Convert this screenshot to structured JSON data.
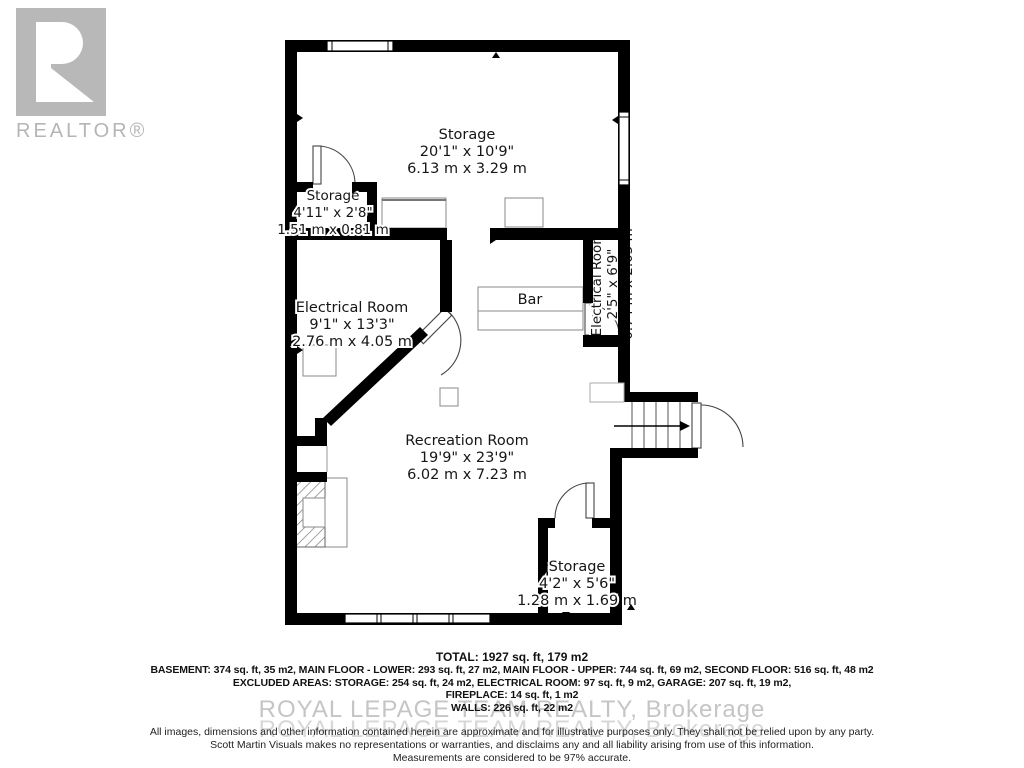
{
  "branding": {
    "logo_label": "REALTOR®",
    "watermark": "ROYAL LEPAGE TEAM REALTY, Brokerage"
  },
  "colors": {
    "wall": "#000000",
    "logo_gray": "#b8b8b8",
    "watermark_gray": "#c5c5c5",
    "label_text": "#161616"
  },
  "rooms": [
    {
      "id": "storage-main",
      "name": "Storage",
      "imperial": "20'1\" x 10'9\"",
      "metric": "6.13 m x 3.29 m"
    },
    {
      "id": "storage-small",
      "name": "Storage",
      "imperial": "4'11\" x 2'8\"",
      "metric": "1.51 m x 0.81 m"
    },
    {
      "id": "electrical-room",
      "name": "Electrical Room",
      "imperial": "9'1\" x 13'3\"",
      "metric": "2.76 m x 4.05 m"
    },
    {
      "id": "electrical-room-right",
      "name": "Electrical Room",
      "imperial": "2'5\" x 6'9\"",
      "metric": "0.74 m x 2.05 m"
    },
    {
      "id": "recreation-room",
      "name": "Recreation Room",
      "imperial": "19'9\" x 23'9\"",
      "metric": "6.02 m x 7.23 m"
    },
    {
      "id": "storage-lower",
      "name": "Storage",
      "imperial": "4'2\" x 5'6\"",
      "metric": "1.28 m x 1.69 m"
    }
  ],
  "fixtures": {
    "bar_label": "Bar"
  },
  "area_summary": {
    "total": "TOTAL: 1927 sq. ft, 179 m2",
    "lines": [
      "BASEMENT: 374 sq. ft, 35 m2, MAIN FLOOR - LOWER: 293 sq. ft, 27 m2, MAIN FLOOR - UPPER: 744 sq. ft, 69 m2, SECOND FLOOR: 516 sq. ft, 48 m2",
      "EXCLUDED AREAS: STORAGE: 254 sq. ft, 24 m2, ELECTRICAL ROOM: 97 sq. ft, 9 m2, GARAGE: 207 sq. ft, 19 m2,",
      "FIREPLACE: 14 sq. ft, 1 m2",
      "WALLS: 226 sq. ft, 22 m2"
    ]
  },
  "disclaimer": {
    "lines": [
      "All images, dimensions and other information contained herein are approximate and for illustrative purposes only. They shall not be relied upon by any party.",
      "Scott Martin Visuals makes no representations or warranties, and disclaims any and all liability arising from use of this information.",
      "Measurements are considered to be 97% accurate."
    ]
  }
}
